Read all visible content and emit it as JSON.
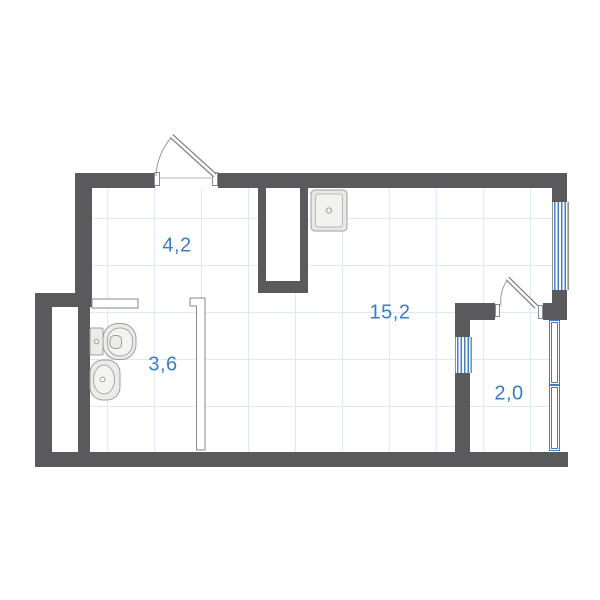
{
  "plan": {
    "room_labels": {
      "hall": "4,2",
      "living": "15,2",
      "bathroom": "3,6",
      "balcony": "2,0"
    },
    "colors": {
      "wall": "#5a5a5c",
      "window_blue": "#3f7ec6",
      "label_blue": "#3b7cc7",
      "grid_blue": "#dde9f6",
      "fixture_fill": "#ebebe9",
      "fixture_stroke": "#9e9e9c",
      "partition_outline": "#8a8a8a"
    }
  }
}
